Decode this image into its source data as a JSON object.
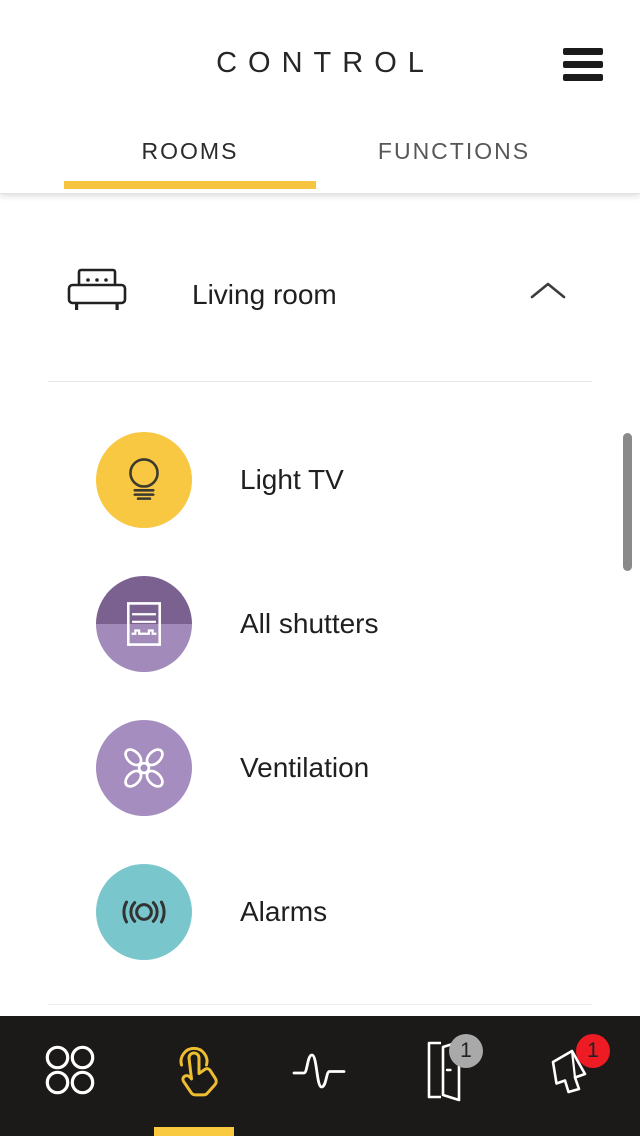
{
  "header": {
    "title": "CONTROL"
  },
  "tabs": {
    "accent": "#F6C440",
    "active_index": 0,
    "items": [
      {
        "label": "ROOMS"
      },
      {
        "label": "FUNCTIONS"
      }
    ]
  },
  "room_header": {
    "name": "Living room",
    "icon": "sofa-icon",
    "state": "expanded"
  },
  "devices": {
    "items": [
      {
        "label": "Light TV",
        "icon": "light-bulb-icon",
        "circle_color": "#F8C843"
      },
      {
        "label": "All shutters",
        "icon": "shutters-icon",
        "circle_top_color": "#7A6190",
        "circle_bottom_color": "#A28BBA"
      },
      {
        "label": "Ventilation",
        "icon": "fan-icon",
        "circle_color": "#A58DC0"
      },
      {
        "label": "Alarms",
        "icon": "alarm-waves-icon",
        "circle_color": "#7AC6CD"
      }
    ]
  },
  "bottom_nav": {
    "background": "#1B1A19",
    "active_index": 1,
    "indicator_color": "#F9C940",
    "active_icon_color": "#EFBE30",
    "items": [
      {
        "name": "apps",
        "icon": "grid-circles-icon"
      },
      {
        "name": "control",
        "icon": "tap-hand-icon"
      },
      {
        "name": "events",
        "icon": "pulse-wave-icon"
      },
      {
        "name": "doors",
        "icon": "door-icon",
        "badge_count": "1",
        "badge_color": "#A9A9A9"
      },
      {
        "name": "alarms",
        "icon": "megaphone-icon",
        "badge_count": "1",
        "badge_color": "#EC1B24"
      }
    ]
  }
}
